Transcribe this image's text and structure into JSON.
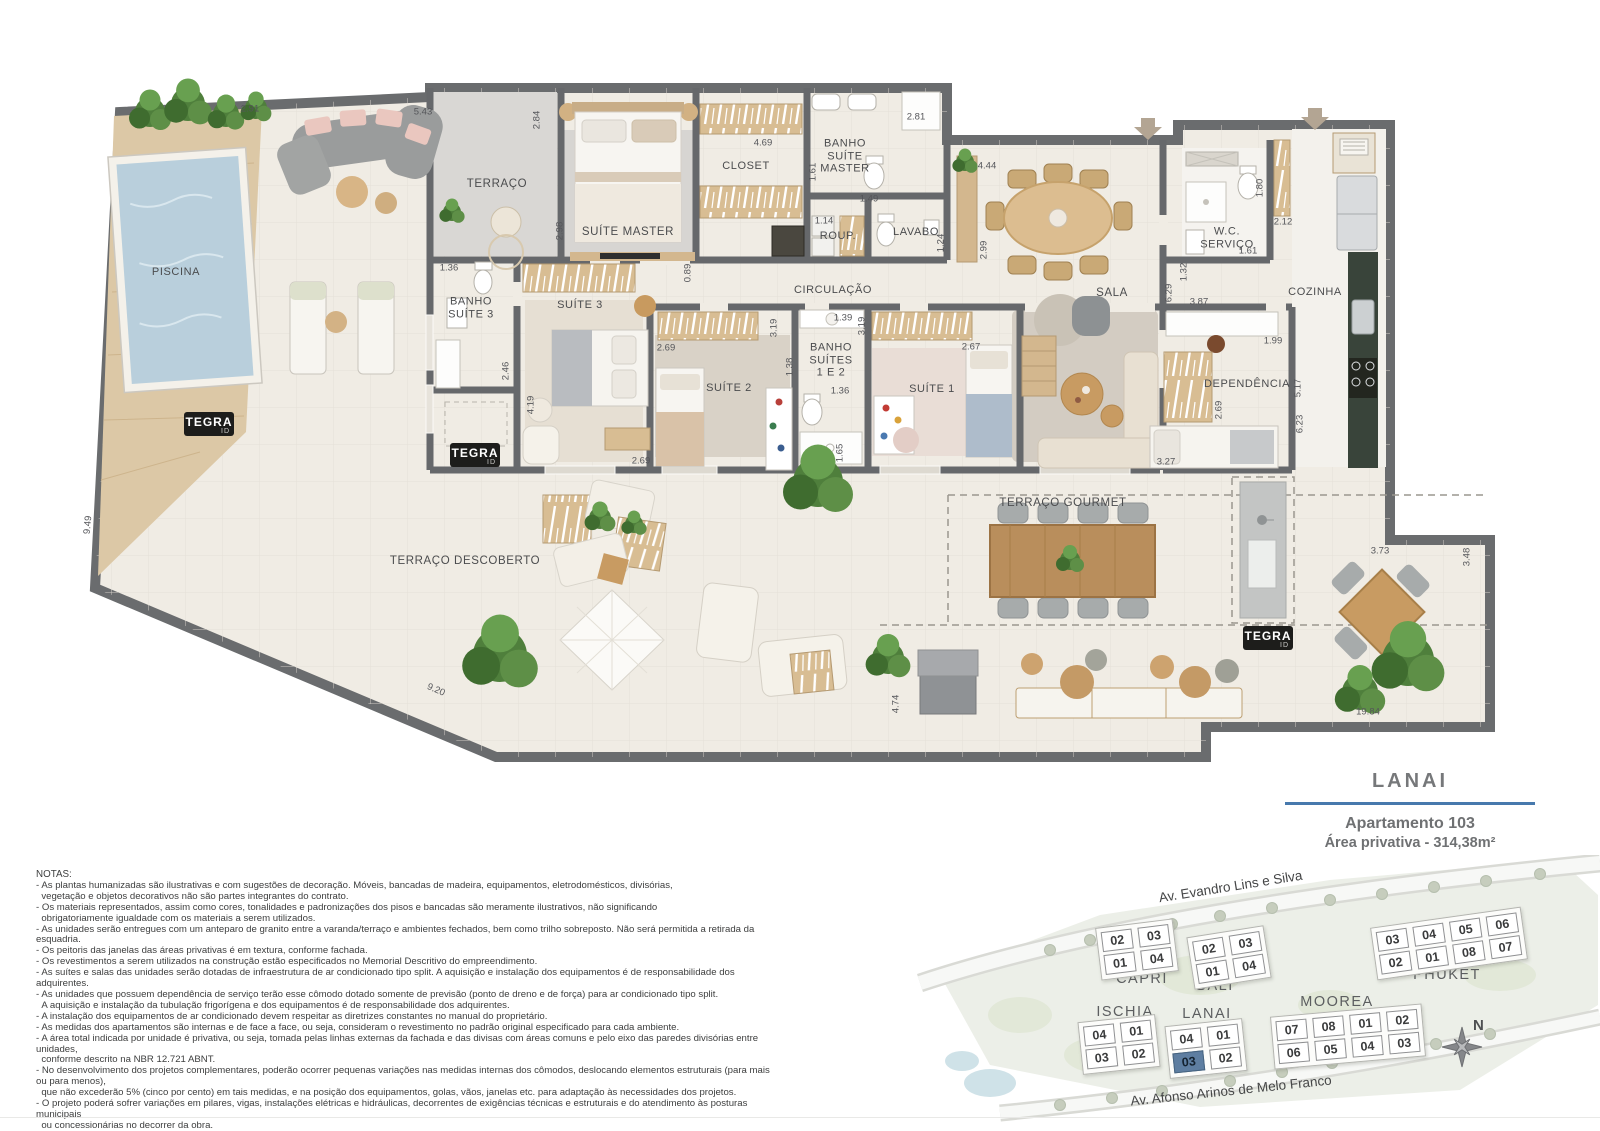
{
  "brand": {
    "tegra": "TEGRA",
    "id": "ID"
  },
  "plan": {
    "rooms": [
      "TERRAÇO",
      "SUÍTE MASTER",
      "CLOSET",
      "BANHO\nSUÍTE\nMASTER",
      "ROUP.",
      "LAVABO",
      "CIRCULAÇÃO",
      "SALA",
      "W.C.\nSERVIÇO",
      "COZINHA",
      "BANHO\nSUÍTE 3",
      "SUÍTE 3",
      "SUÍTE 2",
      "BANHO\nSUÍTES\n1 E 2",
      "SUÍTE 1",
      "DEPENDÊNCIA",
      "PISCINA",
      "TERRAÇO DESCOBERTO",
      "TERRAÇO GOURMET"
    ],
    "dims": [
      "2.91",
      "5.43",
      "2.84",
      "4.69",
      "2.81",
      "1.61",
      "1.49",
      "1.14",
      "1.24",
      "4.44",
      "2.99",
      "1.80",
      "2.12",
      "1.61",
      "1.32",
      "6.29",
      "3.87",
      "2.98",
      "0.89",
      "1.36",
      "2.46",
      "4.19",
      "2.69",
      "2.69",
      "3.19",
      "1.39",
      "3.19",
      "1.38",
      "1.36",
      "1.65",
      "2.67",
      "1.99",
      "2.69",
      "5.17",
      "6.23",
      "3.27",
      "9.49",
      "9.20",
      "4.74",
      "3.73",
      "3.48",
      "19.84"
    ]
  },
  "info": {
    "title": "LANAI",
    "line1": "Apartamento 103",
    "line2": "Área privativa - 314,38m²"
  },
  "notes": {
    "heading": "NOTAS:",
    "lines": [
      "- As plantas humanizadas são ilustrativas e com sugestões de decoração. Móveis, bancadas de madeira, equipamentos, eletrodomésticos, divisórias,",
      "  vegetação e objetos decorativos não são partes integrantes do contrato.",
      "- Os materiais representados, assim como cores, tonalidades e padronizações dos pisos e bancadas são meramente ilustrativos, não significando",
      "  obrigatoriamente igualdade com os materiais a serem utilizados.",
      "- As unidades serão entregues com um anteparo de granito entre a varanda/terraço e ambientes fechados, bem como trilho sobreposto. Não será permitida a retirada da esquadria.",
      "- Os peitoris das janelas das áreas privativas é em textura, conforme fachada.",
      "- Os revestimentos a serem utilizados na construção estão especificados no Memorial Descritivo do empreendimento.",
      "- As suítes e salas das unidades serão dotadas de infraestrutura de ar condicionado tipo split. A aquisição e instalação dos equipamentos é de responsabilidade dos adquirentes.",
      "- As unidades que possuem dependência de serviço terão esse cômodo dotado somente de previsão (ponto de dreno e de força) para ar condicionado tipo split.",
      "  A aquisição e instalação da tubulação frigorígena e dos equipamentos é de responsabilidade dos adquirentes.",
      "- A instalação dos equipamentos de ar condicionado devem respeitar as diretrizes constantes no manual do proprietário.",
      "- As medidas dos apartamentos são internas e de face a face, ou seja, consideram o revestimento no padrão original especificado para cada ambiente.",
      "- A área total indicada por unidade é privativa, ou seja, tomada pelas linhas externas da fachada e das divisas com áreas comuns e pelo eixo das paredes divisórias entre unidades,",
      "  conforme descrito na NBR 12.721 ABNT.",
      "- No desenvolvimento dos projetos complementares, poderão ocorrer pequenas variações nas medidas internas dos cômodos, deslocando elementos estruturais (para mais ou para menos),",
      "  que não excederão 5% (cinco por cento) em tais medidas, e na posição dos equipamentos, golas, vãos, janelas etc. para adaptação às necessidades dos projetos.",
      "- O projeto poderá sofrer variações em pilares, vigas, instalações elétricas e hidráulicas, decorrentes de exigências técnicas e estruturais e do atendimento às posturas municipais",
      "  ou concessionárias no decorrer da obra.",
      "- As seguintes opções serão oferecidas pelo programa Tegra ID e estão sujeitas a cobrança: a) bancada e churrasqueira na varanda/terraço de todas as unidades;",
      "  b) piscinas nas unidades térreas e coberturas; c) banheira no banheiro da suíte master nas coberturas.",
      "- As plantas individuais de cada unidade serão disponibilizadas junto ao contrato de compra e venda do imóvel."
    ]
  },
  "site_map": {
    "street_top": "Av. Evandro Lins e Silva",
    "street_bottom": "Av. Afonso Arinos de Melo Franco",
    "compass": "N",
    "buildings": [
      {
        "name": "CAPRI",
        "cells": [
          [
            "02",
            "03"
          ],
          [
            "01",
            "04"
          ]
        ]
      },
      {
        "name": "BALI",
        "cells": [
          [
            "02",
            "03"
          ],
          [
            "01",
            "04"
          ]
        ]
      },
      {
        "name": "PHUKET",
        "cells": [
          [
            "03",
            "04",
            "05",
            "06"
          ],
          [
            "02",
            "01",
            "08",
            "07"
          ]
        ]
      },
      {
        "name": "MOOREA",
        "cells": [
          [
            "07",
            "08",
            "01",
            "02"
          ],
          [
            "06",
            "05",
            "04",
            "03"
          ]
        ]
      },
      {
        "name": "ISCHIA",
        "cells": [
          [
            "04",
            "01"
          ],
          [
            "03",
            "02"
          ]
        ]
      },
      {
        "name": "LANAI",
        "cells": [
          [
            "04",
            "01"
          ],
          [
            "03",
            "02"
          ]
        ]
      }
    ]
  }
}
